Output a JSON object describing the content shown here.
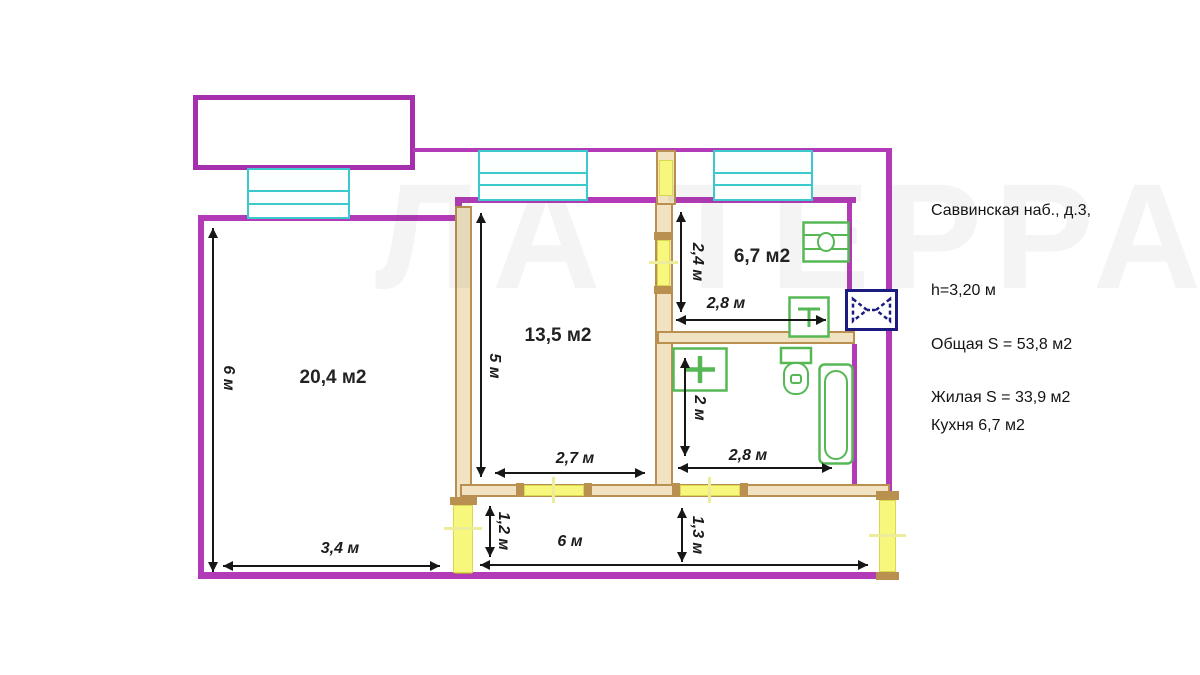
{
  "watermark": "ЛА ТЕРРА",
  "info": {
    "address": "Саввинская наб., д.3,",
    "ceiling_height": "h=3,20 м",
    "total_area": "Общая S = 53,8 м2",
    "living_area": "Жилая S = 33,9 м2",
    "kitchen_area": "Кухня 6,7 м2"
  },
  "rooms": {
    "living_room": "20,4 м2",
    "bedroom": "13,5 м2",
    "kitchen": "6,7 м2"
  },
  "dimensions": {
    "living_height": "6 м",
    "living_width": "3,4 м",
    "bedroom_height": "5 м",
    "bedroom_width": "2,7 м",
    "kitchen_height": "2,4 м",
    "kitchen_width": "2,8 м",
    "bathroom_height": "2 м",
    "bathroom_width": "2,8 м",
    "hall_left_width": "1,2 м",
    "hall_length": "6 м",
    "hall_mid_width": "1,3 м"
  },
  "colors": {
    "exterior_wall": "#b23ab6",
    "interior_wall": "#b9904f",
    "door": "#f7f77d",
    "window": "#3cc9cd",
    "fixture": "#55b855",
    "vent": "#1c1c80",
    "dimension": "#171717"
  }
}
